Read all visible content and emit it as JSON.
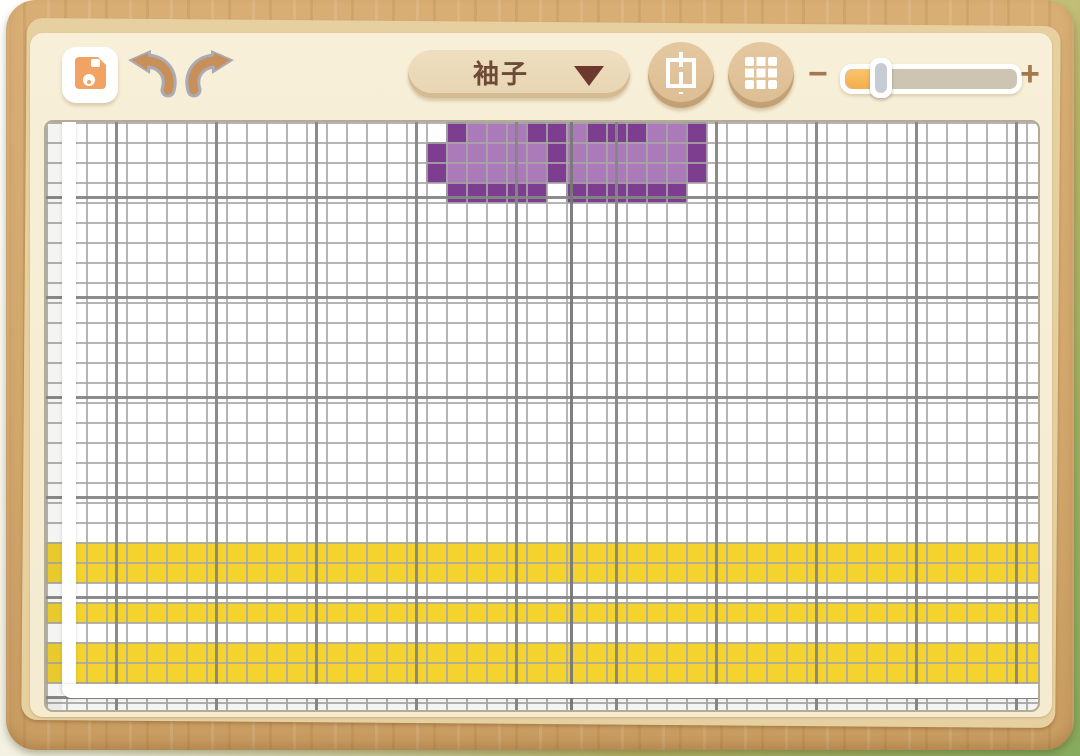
{
  "toolbar": {
    "save_button": {
      "icon": "floppy-disk-icon"
    },
    "undo_button": {
      "icon": "undo-arrow-icon"
    },
    "redo_button": {
      "icon": "redo-arrow-icon"
    },
    "part_dropdown": {
      "selected_label": "袖子"
    },
    "symmetry_button": {
      "icon": "mirror-symmetry-icon"
    },
    "grid_toggle_button": {
      "icon": "grid-icon"
    },
    "zoom_slider": {
      "minus_label": "−",
      "plus_label": "+",
      "value_percent": 15
    }
  },
  "canvas": {
    "grid": {
      "columns": 49,
      "rows": 29,
      "cell_size_px": 20,
      "background": "#ffffff",
      "minor_line_color": "#a8a8a8",
      "major_line_color": "#868686",
      "major_every_cells": 5
    },
    "piece_boundary": {
      "style": "white-band-left-and-bottom"
    },
    "palette": {
      "D": "#7d3e8f",
      "L": "#aa7ab9",
      "Y": "#f4d32e"
    },
    "motif": {
      "name": "purple-pixel-pattern",
      "origin_col": 19,
      "origin_row": 0,
      "rows": [
        ".DLLLDDLDDDLLD.",
        "DLLLLLDLLLLLLD.",
        "DLLLLLDLLLLLLD.",
        ".DDDDD.DDDDDD.."
      ]
    },
    "stripes": {
      "color_key": "Y",
      "rows": [
        21,
        22,
        24,
        26,
        27
      ]
    }
  }
}
